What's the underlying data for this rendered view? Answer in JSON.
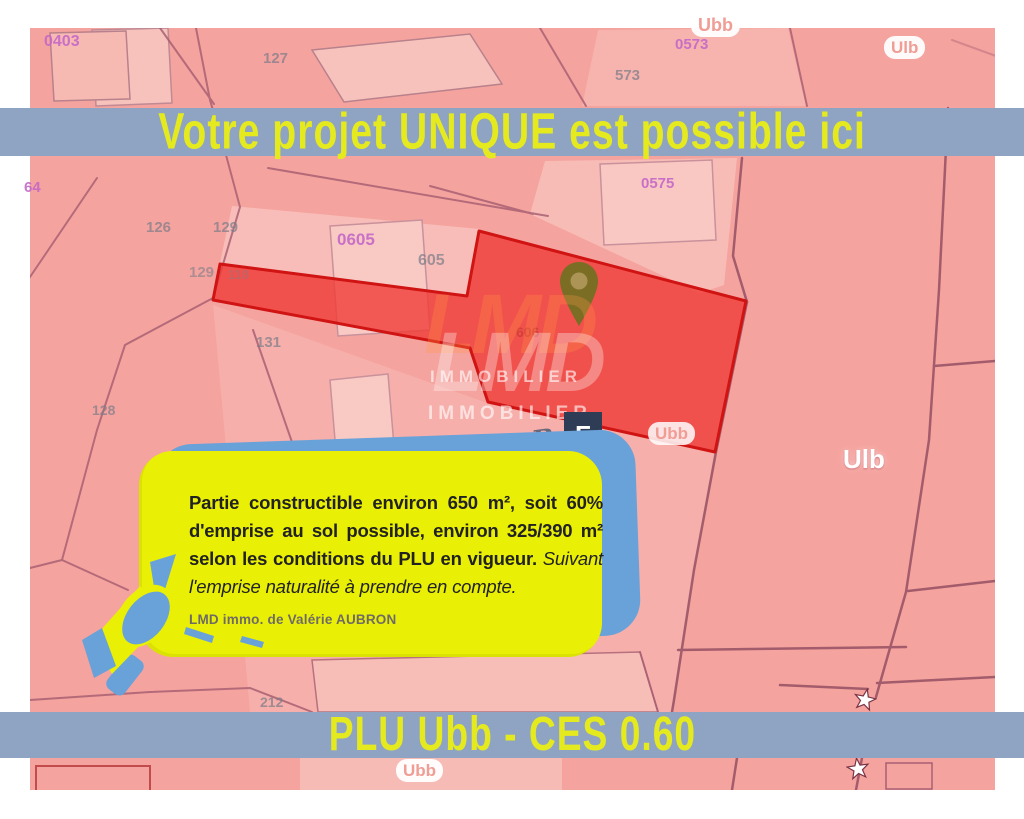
{
  "banner_top": {
    "text": "Votre projet UNIQUE est possible ici"
  },
  "banner_bottom": {
    "text": "PLU Ubb - CES 0.60"
  },
  "callout": {
    "main_bold": "Partie constructible environ 650 m², soit 60% d'emprise au sol possible, environ 325/390 m² selon les conditions du PLU en vigueur.",
    "main_italic": " Suivant l'emprise naturalité à prendre en compte.",
    "signature": "LMD immo. de Valérie AUBRON"
  },
  "watermark": {
    "brand_top": "LMD",
    "brand_bottom": "LMD",
    "word_1": "IMMOBILIER",
    "word_2": "IMMOBILIER",
    "by_text": "By",
    "logo_letter": "F"
  },
  "map": {
    "zones": {
      "ubb_top": "Ubb",
      "ulb_top_right": "Ulb",
      "ubb_on_parcel": "Ubb",
      "ulb_mid_right": "Ulb",
      "ubb_bottom": "Ubb"
    },
    "parcels": {
      "p0403": "0403",
      "p64": "64",
      "p127": "127",
      "p0573": "0573",
      "p573": "573",
      "p0575": "0575",
      "p126": "126",
      "p129a": "129",
      "p129b": "129",
      "p118": "118",
      "p0605": "0605",
      "p605": "605",
      "p606": "606",
      "p131": "131",
      "p128": "128",
      "p212": "212"
    }
  },
  "colors": {
    "banner_bg": "#8fa3c3",
    "banner_text": "#e5ea1e",
    "map_pink": "#f5a39e",
    "parcel_light": "#f8c2bc",
    "highlight_red_fill": "#ee3a34",
    "highlight_red_border": "#d01313",
    "callout_yellow": "#eaf005",
    "callout_blue": "#69a1d9",
    "label_purple": "#c468c8",
    "pin_olive": "#7b6e24"
  }
}
